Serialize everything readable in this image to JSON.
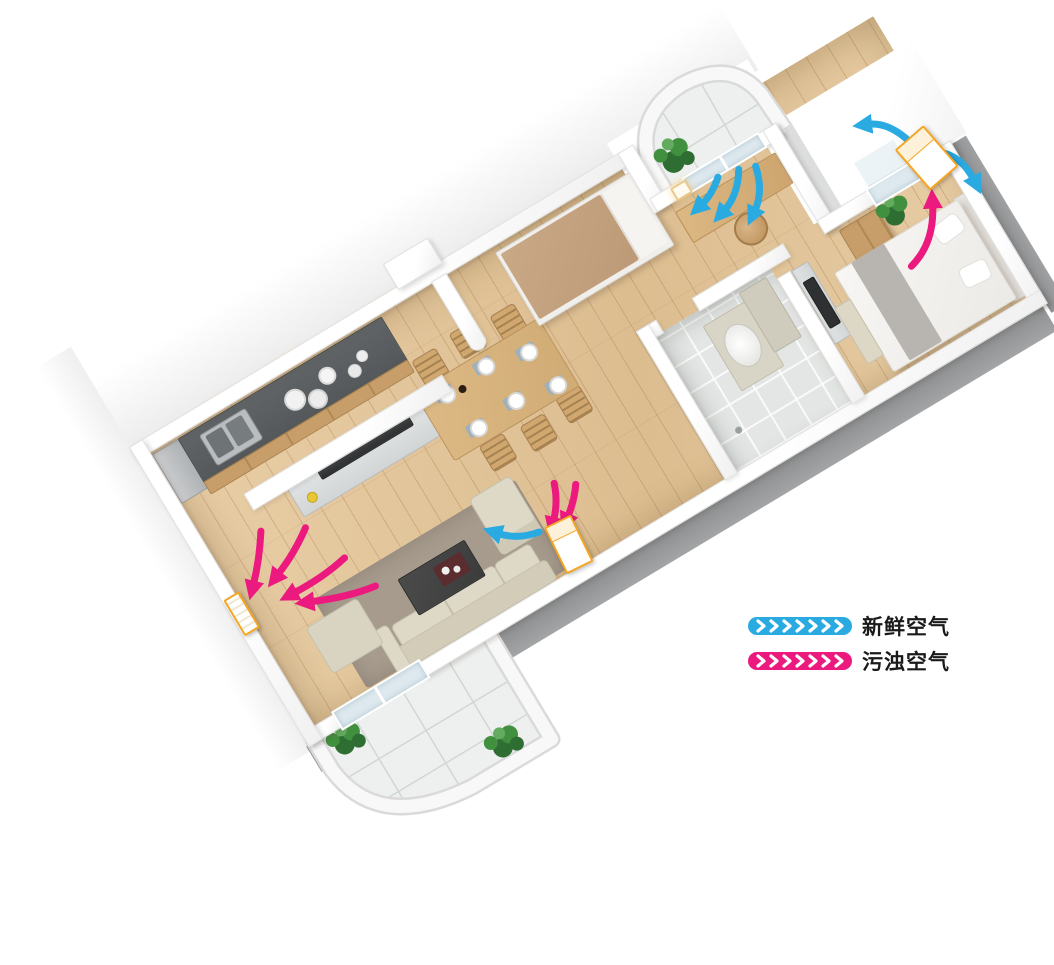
{
  "legend": {
    "items": [
      {
        "id": "fresh-air",
        "label": "新鲜空气",
        "color": "#29abe2"
      },
      {
        "id": "polluted-air",
        "label": "污浊空气",
        "color": "#ec1a7f"
      }
    ]
  },
  "scene": {
    "type": "3d-cutaway-floor-plan",
    "subject": "two-bedroom apartment with fresh-air ventilation airflow",
    "rooms": [
      "living-room",
      "kitchen",
      "dining-area",
      "entry",
      "small-bedroom",
      "study",
      "master-bedroom",
      "bathroom",
      "balcony-front",
      "balcony-rear"
    ]
  },
  "colors": {
    "fresh": "#29abe2",
    "polluted": "#ec1a7f",
    "ventOutline": "#f5a623",
    "wallEdge": "#e2e2e2",
    "wallSide": "#8b8d8f",
    "floorWood": "#e9cea6",
    "floorWoodDark": "#dcbd90",
    "tile": "#edf0ee",
    "bathTile": "#e3e6e4",
    "counter": "#54585a",
    "steel": "#b9bdbf",
    "cabinet": "#c79e69",
    "woodFurn": "#ddb985",
    "woodChair": "#cfa76f",
    "sofa": "#ded8c7",
    "rug": "#a69b8d",
    "tableDark": "#3b3c3b",
    "console": "#d2d5d6",
    "tv": "#2e3032",
    "mattress": "#c9a886",
    "bedWhite": "#f7f6f4",
    "blanket": "#b8b4af",
    "plant": "#41903f",
    "plantDark": "#2f6e33",
    "glass": "#dde9ef",
    "legendText": "#1a1a1a"
  }
}
